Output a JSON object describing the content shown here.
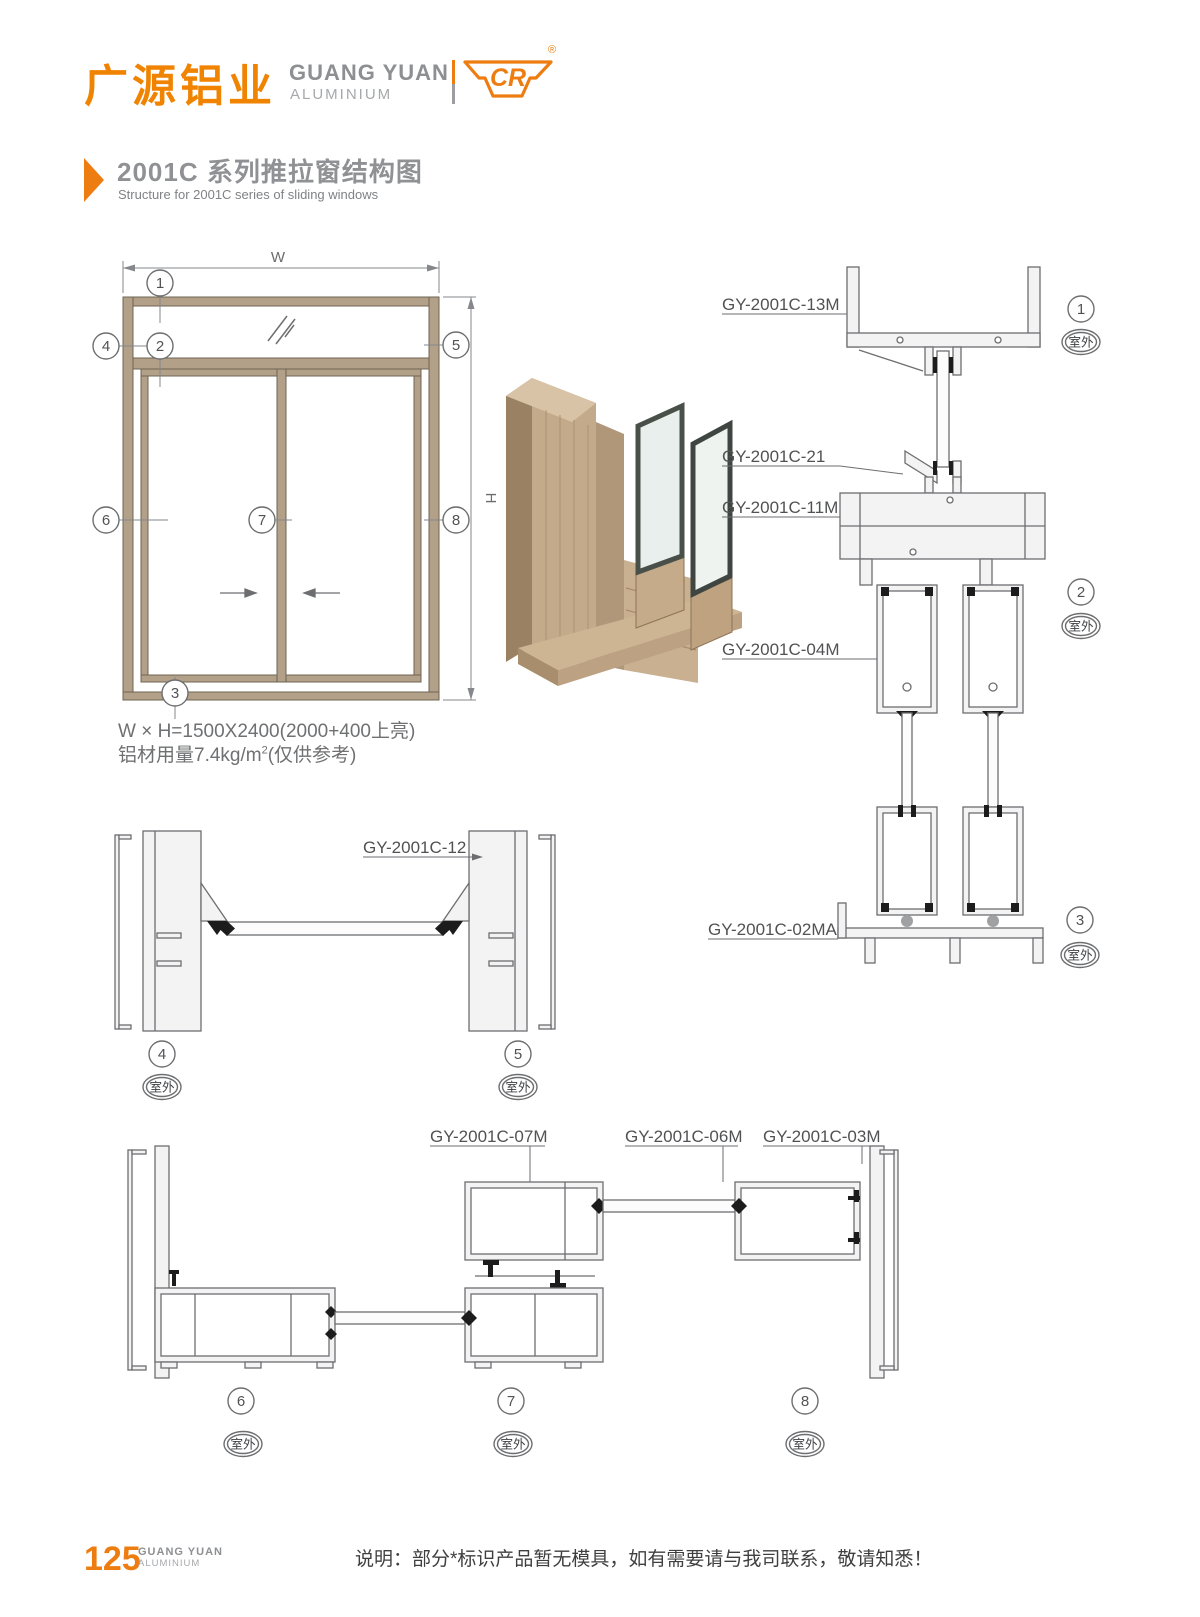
{
  "header": {
    "brand_cn": "广源铝业",
    "brand_en": "GUANG YUAN",
    "brand_sub": "ALUMINIUM",
    "logo_text": "CR",
    "registered_mark": "®"
  },
  "title": {
    "cn": "2001C 系列推拉窗结构图",
    "en": "Structure for 2001C series of sliding windows"
  },
  "elevation": {
    "dim_w": "W",
    "dim_h": "H",
    "spec_line1": "W × H=1500X2400(2000+400上亮)",
    "spec_line2_pre": "铝材用量7.4kg/m",
    "spec_line2_sup": "2",
    "spec_line2_post": "(仅供参考)"
  },
  "callouts": {
    "c1": "1",
    "c2": "2",
    "c3": "3",
    "c4": "4",
    "c5": "5",
    "c6": "6",
    "c7": "7",
    "c8": "8"
  },
  "outdoor": "室外",
  "parts": {
    "p13m": "GY-2001C-13M",
    "p21": "GY-2001C-21",
    "p11m": "GY-2001C-11M",
    "p04m": "GY-2001C-04M",
    "p02ma": "GY-2001C-02MA",
    "p12": "GY-2001C-12",
    "p07m": "GY-2001C-07M",
    "p06m": "GY-2001C-06M",
    "p03m": "GY-2001C-03M"
  },
  "footer": {
    "page_number": "125",
    "brand_en": "GUANG YUAN",
    "brand_sub": "ALUMINIUM",
    "note": "说明：部分*标识产品暂无模具，如有需要请与我司联系，敬请知悉！"
  },
  "colors": {
    "accent": "#ee7d11",
    "brand_gray": "#8d8f92",
    "line_gray": "#6d6e70",
    "frame_tan": "#b3a089",
    "seal_black": "#1c1c1c"
  }
}
